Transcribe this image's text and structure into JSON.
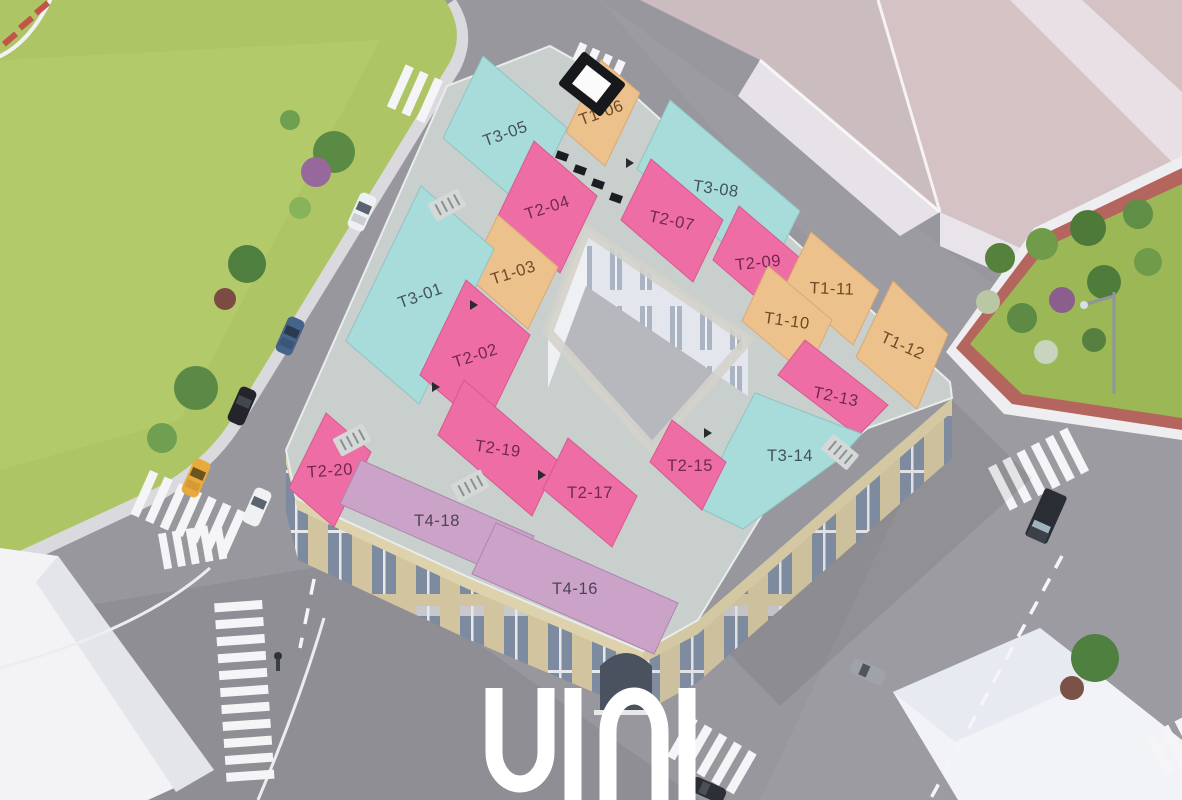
{
  "logo": {
    "text": "UINI"
  },
  "units": [
    {
      "id": "T3-05",
      "category": "T3"
    },
    {
      "id": "T1-06",
      "category": "T1"
    },
    {
      "id": "T3-08",
      "category": "T3"
    },
    {
      "id": "T2-04",
      "category": "T2"
    },
    {
      "id": "T2-07",
      "category": "T2"
    },
    {
      "id": "T2-09",
      "category": "T2"
    },
    {
      "id": "T1-11",
      "category": "T1"
    },
    {
      "id": "T1-03",
      "category": "T1"
    },
    {
      "id": "T1-10",
      "category": "T1"
    },
    {
      "id": "T3-01",
      "category": "T3"
    },
    {
      "id": "T1-12",
      "category": "T1"
    },
    {
      "id": "T2-02",
      "category": "T2"
    },
    {
      "id": "T2-13",
      "category": "T2"
    },
    {
      "id": "T2-19",
      "category": "T2"
    },
    {
      "id": "T3-14",
      "category": "T3"
    },
    {
      "id": "T2-20",
      "category": "T2"
    },
    {
      "id": "T2-17",
      "category": "T2"
    },
    {
      "id": "T2-15",
      "category": "T2"
    },
    {
      "id": "T4-18",
      "category": "T4"
    },
    {
      "id": "T4-16",
      "category": "T4"
    }
  ],
  "category_colors": {
    "T1": "#ecc18c",
    "T2": "#ee6da4",
    "T3": "#a7dcda",
    "T4": "#cba3c9"
  },
  "label_colors": {
    "T1": "#6d4a26",
    "T2": "#71294e",
    "T3": "#44525a",
    "T4": "#4e4258"
  }
}
